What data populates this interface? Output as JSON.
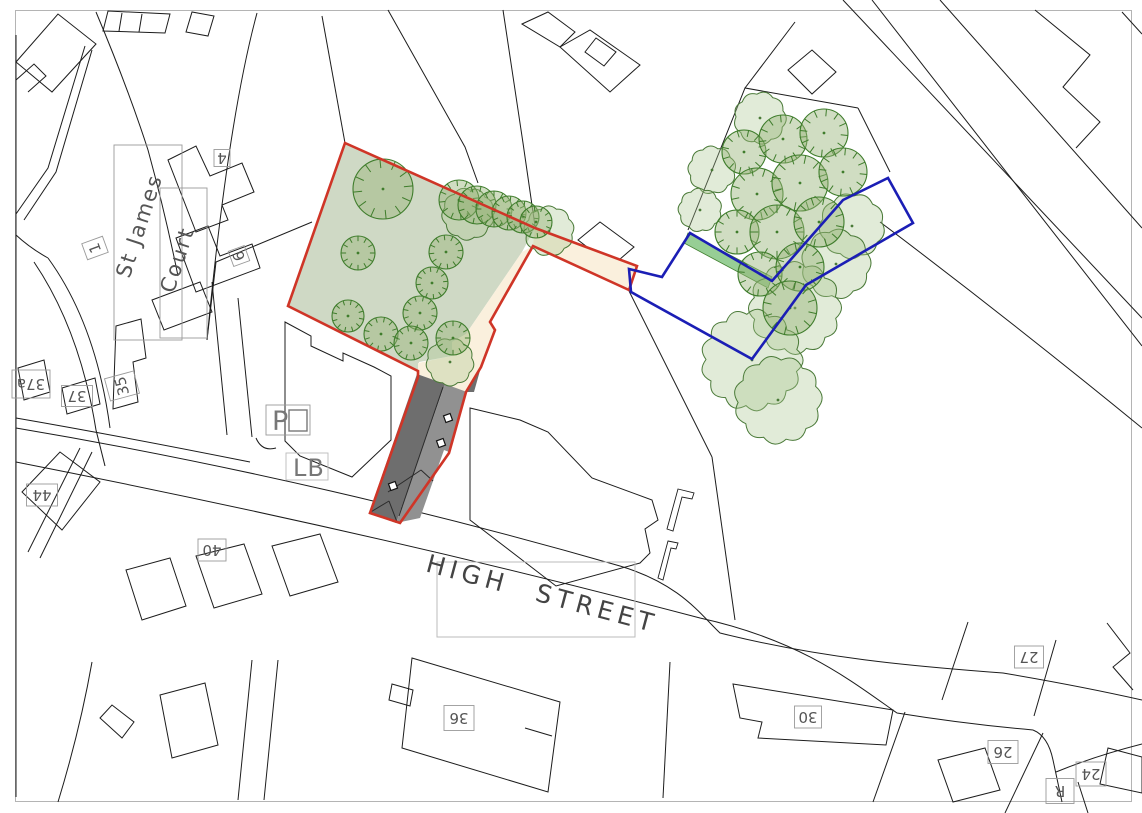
{
  "canvas": {
    "width": 1142,
    "height": 813,
    "background": "#ffffff"
  },
  "colors": {
    "linework": "#1c1c1c",
    "frame": "#b4b4b4",
    "site_green": "#cfd9c5",
    "path_cream": "#faf0dd",
    "hedge_green": "#8cc98a",
    "roof_dark": "#6e6e6e",
    "roof_light": "#919191",
    "roof_line": "#2a2a2a",
    "red_boundary": "#cf3527",
    "blue_boundary": "#1b1eb5",
    "tree_stroke": "#3f7d2c",
    "tree_fill": "rgba(150,180,120,0.45)",
    "canopy_stroke": "#4a7a38",
    "canopy_fill": "rgba(170,198,142,0.35)",
    "label_text": "#555555",
    "label_box": "#9a9a9a",
    "street_text": "#444444",
    "street_box": "#bbbbbb",
    "os_symbol": "#777777"
  },
  "frame": {
    "x": 15.5,
    "y": 10.5,
    "w": 1116,
    "h": 791
  },
  "boundaries": {
    "red_site": "M345,143 L535,228 L637,266 L629,290 L533,246 L490,322 L495,330 L481,367 L466,392 L449,453 L400,523 L370,513 L418,377 L418,371 L288,306 Z",
    "blue_land": "M629,269 L662,277 L690,233 L772,281 L843,200 L888,178 L913,223 L806,285 L752,359 L631,292 Z"
  },
  "areas": {
    "green_site": "M345,143 L535,228 L522,252 L466,334 L452,342 L452,356 L419,362 L418,372 L288,306 Z",
    "cream_corridor": "M535,227 L638,266 L630,291 L533,246 Z",
    "cream_path": "M533,246 L490,322 L495,330 L481,367 L466,392 L445,385 L418,374 L418,363 L452,356 L452,342 L466,334 L522,252 Z",
    "hedge": "M688,233 L772,277 L768,288 L684,243 Z"
  },
  "building": {
    "dark": "M417,374 L445,384 L396,523 L369,513 Z",
    "light": "M445,384 L467,392 L449,452 L444,450 L420,518 L396,523 Z",
    "wedge": "M467,392 L481,367 L474,392 Z",
    "ridges": [
      "M443,387 L399,516",
      "M369,513 L389,501",
      "M389,501 L397,522",
      "M388,492 L421,470",
      "M421,470 L433,481"
    ],
    "rooflights": [
      [
        448,
        418
      ],
      [
        441,
        443
      ],
      [
        393,
        486
      ]
    ],
    "rooflight_size": 7,
    "rooflight_angle": -20
  },
  "trees": {
    "ticked": [
      [
        383,
        189,
        30
      ],
      [
        358,
        253,
        17
      ],
      [
        446,
        252,
        17
      ],
      [
        432,
        283,
        16
      ],
      [
        420,
        313,
        17
      ],
      [
        348,
        316,
        16
      ],
      [
        381,
        334,
        17
      ],
      [
        411,
        343,
        17
      ],
      [
        453,
        338,
        17
      ],
      [
        459,
        200,
        20
      ],
      [
        477,
        205,
        19
      ],
      [
        494,
        209,
        18
      ],
      [
        509,
        213,
        17
      ],
      [
        523,
        217,
        16
      ],
      [
        536,
        222,
        16
      ],
      [
        744,
        152,
        22
      ],
      [
        783,
        139,
        24
      ],
      [
        824,
        133,
        24
      ],
      [
        757,
        194,
        26
      ],
      [
        800,
        183,
        28
      ],
      [
        843,
        172,
        24
      ],
      [
        737,
        232,
        22
      ],
      [
        777,
        232,
        27
      ],
      [
        819,
        222,
        25
      ],
      [
        760,
        274,
        22
      ],
      [
        800,
        267,
        24
      ],
      [
        790,
        308,
        27
      ]
    ],
    "scalloped": [
      [
        468,
        214,
        24
      ],
      [
        549,
        231,
        23
      ],
      [
        450,
        362,
        22
      ],
      [
        712,
        170,
        22
      ],
      [
        760,
        118,
        24
      ],
      [
        700,
        210,
        20
      ],
      [
        852,
        226,
        30
      ],
      [
        836,
        264,
        32
      ],
      [
        795,
        308,
        42
      ],
      [
        752,
        360,
        46
      ],
      [
        778,
        400,
        40
      ]
    ]
  },
  "linework": [
    "M16,35 L16,797",
    "M16,62 L58,14 L96,44 L52,92 Z",
    "M16,80 L34,64 L46,76 L28,92",
    "M85,46 L48,168 L16,214",
    "M92,50 L56,172 L24,220",
    "M96,12 Q128,88 148,150 Q165,212 178,276",
    "M103,31 L108,11 L170,14 L165,33 Z",
    "M122,13 L119,31",
    "M142,14 L139,32",
    "M186,32 L192,12 L214,16 L208,36 Z",
    "M257,13 Q228,120 207,340",
    "M312,222 L216,262 L207,340",
    "M345,143 L322,16",
    "M388,10 L465,147 L478,183",
    "M503,10 L523,143 L535,226",
    "M168,160 L196,146 L210,176 L242,163 L254,192 L222,205 L228,220 L196,232 Z",
    "M176,238 L208,226 L220,256 L252,244 L260,268 L196,292 Z",
    "M152,300 L200,282 L212,312 L164,330 Z",
    "M212,282 L227,435",
    "M238,298 L252,437",
    "M116,326 L141,319 L146,358 L133,362 L138,402 L113,409 Z",
    "M62,388 L95,378 L100,404 L67,414 Z",
    "M18,368 L44,360 L50,392 L24,400 Z",
    "M34,262 Q80,330 96,430",
    "M48,258 Q96,324 110,428",
    "M285,322 L311,336 L311,346 L343,361 L343,353 L374,367 L391,376 L391,440 L352,477 L300,456 L285,441 Z",
    "M256,438 Q262,452 276,448",
    "M16,428 C230,464 440,514 620,566 C680,584 700,614 720,633 C820,658 910,666 1003,673 Q1080,686 1142,700",
    "M16,462 C250,508 480,560 700,618 C800,640 850,680 897,713 Q965,724 1033,730",
    "M16,418 Q120,436 250,462",
    "M96,430 L105,466",
    "M1033,730 Q1048,736 1053,760 L1062,802",
    "M1056,772 Q1095,756 1142,744",
    "M1078,782 L1088,813",
    "M22,492 L60,452 L100,482 L62,530 Z",
    "M80,448 L28,552",
    "M92,452 L40,558",
    "M126,570 L170,558 L186,606 L142,620 Z",
    "M196,556 L244,544 L262,594 L214,608 Z",
    "M272,546 L320,534 L338,582 L290,596 Z",
    "M100,718 L112,705 L134,722 L122,738 Z",
    "M160,695 L205,683 L218,745 L172,758 Z",
    "M92,662 Q80,730 58,802",
    "M252,660 L238,800",
    "M278,660 L264,800",
    "M412,658 L560,702 L548,792 L402,748 Z",
    "M392,684 L413,690 L410,706 L389,700 Z",
    "M525,728 L552,736",
    "M670,662 L663,798",
    "M733,684 L893,710 L886,745 L758,738 L762,722 L740,718 Z",
    "M712,457 L735,620",
    "M905,712 L873,802",
    "M1043,733 L1005,813",
    "M968,622 L942,700",
    "M1056,640 L1034,716",
    "M938,760 L985,748 L1000,790 L953,802 Z",
    "M1108,748 L1142,757 L1142,793 L1100,784 Z",
    "M1107,623 L1130,653 L1113,667 L1133,690",
    "M843,0 L1142,318",
    "M872,0 L1142,346",
    "M940,0 L1142,228",
    "M1035,10 L1090,55 L1063,87 L1100,122 L1076,148",
    "M1122,12 L1142,34",
    "M788,70 L812,50 L836,72 L812,94 Z",
    "M745,88 L795,22",
    "M688,230 L745,88 L858,108",
    "M858,108 L890,172",
    "M880,222 Q1010,320 1142,428",
    "M629,291 L712,457",
    "M578,240 L600,222 L634,247 L612,266 Z",
    "M470,408 L520,420 L548,432 L592,478 L652,500 L658,520 L645,529 L650,553 L640,563 L556,586 L470,520 Z",
    "M522,24 L548,12 L575,32 L560,47 Z",
    "M560,47 L590,30 L640,65 L610,92 Z",
    "M596,38 L616,52 L604,66 L585,52 Z",
    "M16,235 Q30,248 48,258"
  ],
  "gate_symbols": [
    "M678,489 L694,493 L692,499 L682,497 L673,531 L667,529 Z",
    "M668,541 L678,543 L676,549 L671,548 L663,580 L658,578 Z"
  ],
  "labels": {
    "street": {
      "text": "HIGH STREET",
      "box": [
        437,
        562,
        198,
        75
      ],
      "cx": 540,
      "cy": 602,
      "rot": 15,
      "size": 25
    },
    "st_james": {
      "line1": "St James",
      "line2": "Court",
      "box1": [
        114,
        145,
        68,
        195
      ],
      "box2": [
        160,
        188,
        47,
        150
      ],
      "rot": -72,
      "c1": [
        146,
        228
      ],
      "c2": [
        184,
        262
      ],
      "size": 21
    },
    "po": {
      "text": "P",
      "box": [
        266,
        405,
        44,
        30
      ],
      "square": [
        289,
        410,
        18,
        21
      ]
    },
    "lb": {
      "text": "LB",
      "box": [
        286,
        453,
        42,
        27
      ]
    },
    "numbers": [
      {
        "t": "4",
        "x": 222,
        "y": 158,
        "w": 16,
        "h": 17,
        "rot": 180
      },
      {
        "t": "1",
        "x": 95,
        "y": 248,
        "w": 17,
        "h": 22,
        "rot": 250
      },
      {
        "t": "6",
        "x": 239,
        "y": 256,
        "w": 16,
        "h": 17,
        "rot": 250
      },
      {
        "t": "37a",
        "x": 31,
        "y": 384,
        "w": 38,
        "h": 28,
        "rot": 180
      },
      {
        "t": "37",
        "x": 77,
        "y": 396,
        "w": 31,
        "h": 21,
        "rot": 180
      },
      {
        "t": "35",
        "x": 122,
        "y": 386,
        "w": 23,
        "h": 30,
        "rot": 255
      },
      {
        "t": "44",
        "x": 42,
        "y": 495,
        "w": 31,
        "h": 22,
        "rot": 180
      },
      {
        "t": "40",
        "x": 212,
        "y": 550,
        "w": 28,
        "h": 22,
        "rot": 180
      },
      {
        "t": "36",
        "x": 459,
        "y": 718,
        "w": 30,
        "h": 25,
        "rot": 180
      },
      {
        "t": "30",
        "x": 808,
        "y": 717,
        "w": 27,
        "h": 22,
        "rot": 180
      },
      {
        "t": "27",
        "x": 1029,
        "y": 657,
        "w": 29,
        "h": 22,
        "rot": 180
      },
      {
        "t": "26",
        "x": 1003,
        "y": 752,
        "w": 30,
        "h": 23,
        "rot": 180
      },
      {
        "t": "24",
        "x": 1091,
        "y": 774,
        "w": 30,
        "h": 24,
        "rot": 180
      },
      {
        "t": "R",
        "x": 1060,
        "y": 791,
        "w": 28,
        "h": 25,
        "rot": 180
      }
    ]
  }
}
